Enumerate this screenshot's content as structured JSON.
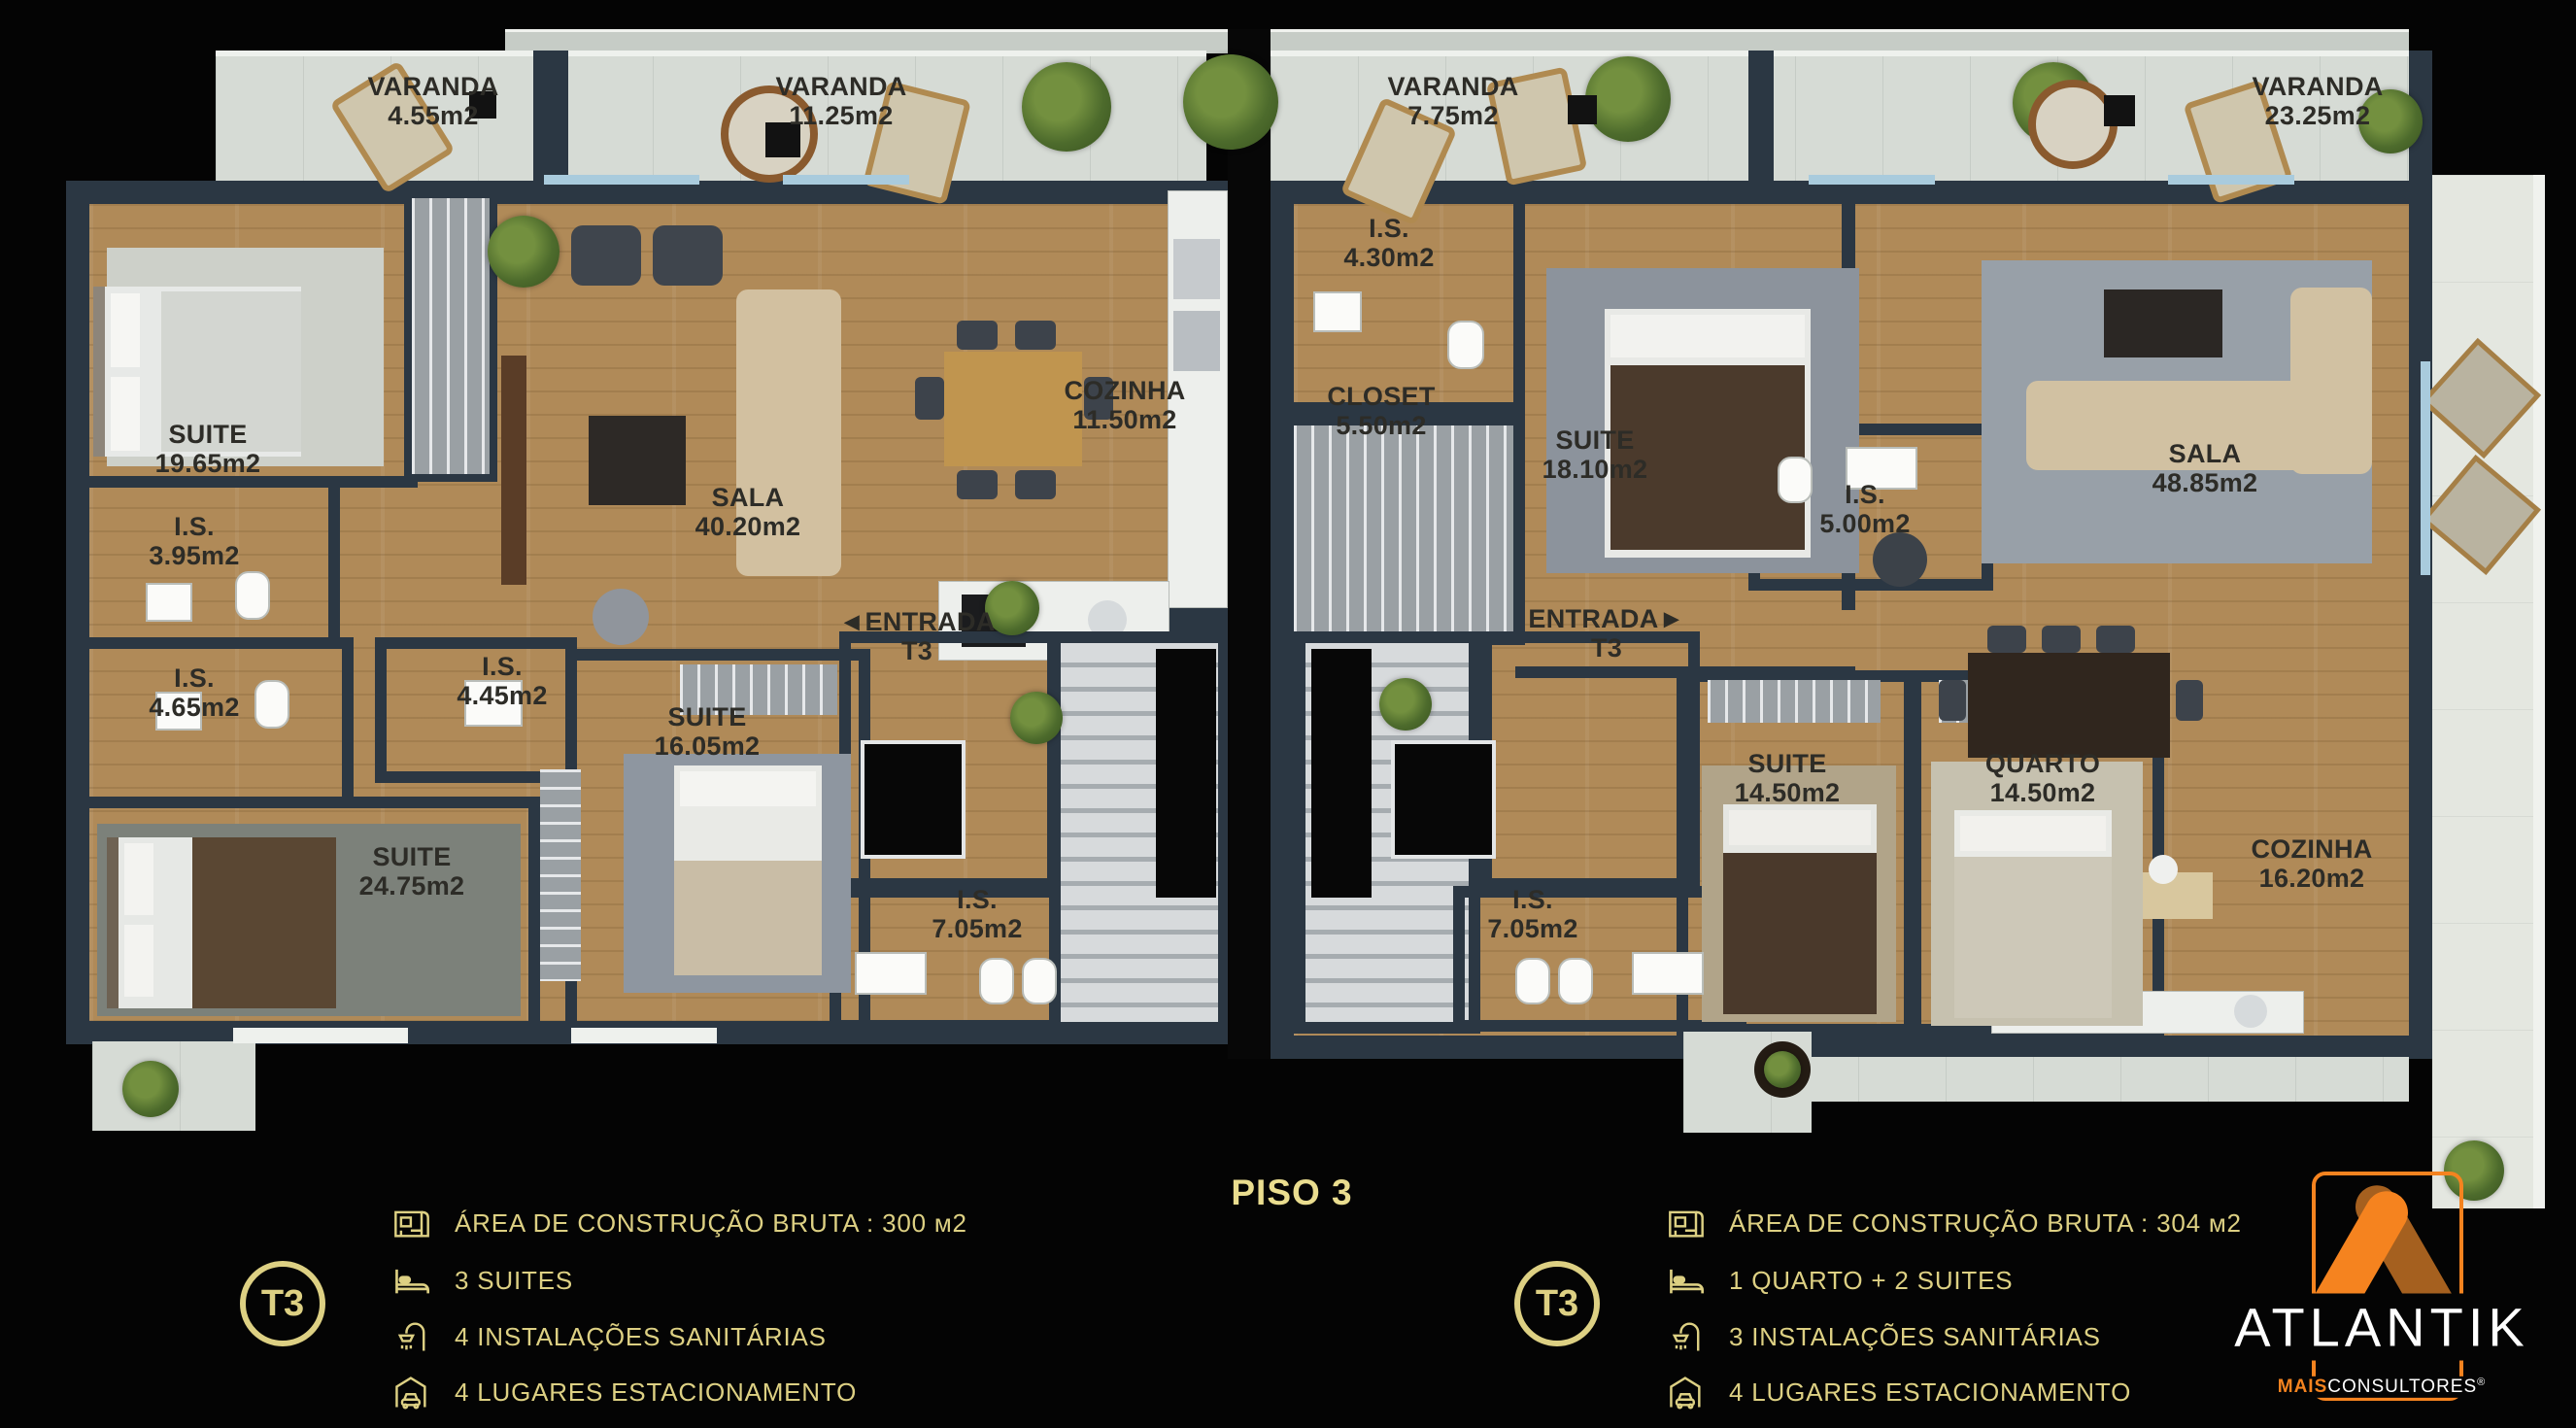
{
  "floor_title": "PISO 3",
  "varandas": [
    {
      "name": "VARANDA",
      "area": "4.55m2"
    },
    {
      "name": "VARANDA",
      "area": "11.25m2"
    },
    {
      "name": "VARANDA",
      "area": "7.75m2"
    },
    {
      "name": "VARANDA",
      "area": "23.25m2"
    }
  ],
  "unit_left": {
    "rooms": [
      {
        "name": "SUITE",
        "area": "19.65m2"
      },
      {
        "name": "I.S.",
        "area": "3.95m2"
      },
      {
        "name": "I.S.",
        "area": "4.65m2"
      },
      {
        "name": "SUITE",
        "area": "24.75m2"
      },
      {
        "name": "I.S.",
        "area": "4.45m2"
      },
      {
        "name": "SUITE",
        "area": "16.05m2"
      },
      {
        "name": "SALA",
        "area": "40.20m2"
      },
      {
        "name": "COZINHA",
        "area": "11.50m2"
      },
      {
        "name": "I.S.",
        "area": "7.05m2"
      }
    ],
    "entrance": {
      "arrow": "◄",
      "name": "ENTRADA",
      "unit": "T3"
    }
  },
  "unit_right": {
    "rooms": [
      {
        "name": "I.S.",
        "area": "4.30m2"
      },
      {
        "name": "CLOSET",
        "area": "5.50m2"
      },
      {
        "name": "SUITE",
        "area": "18.10m2"
      },
      {
        "name": "I.S.",
        "area": "5.00m2"
      },
      {
        "name": "SALA",
        "area": "48.85m2"
      },
      {
        "name": "SUITE",
        "area": "14.50m2"
      },
      {
        "name": "QUARTO",
        "area": "14.50m2"
      },
      {
        "name": "COZINHA",
        "area": "16.20m2"
      },
      {
        "name": "I.S.",
        "area": "7.05m2"
      }
    ],
    "entrance": {
      "arrow": "►",
      "name": "ENTRADA",
      "unit": "T3"
    }
  },
  "legend_left": {
    "badge": "T3",
    "items": [
      {
        "icon": "blueprint-icon",
        "label": "ÁREA DE CONSTRUÇÃO BRUTA :  300 м2"
      },
      {
        "icon": "bed-icon",
        "label": "3 SUITES"
      },
      {
        "icon": "shower-icon",
        "label": "4 INSTALAÇÕES SANITÁRIAS"
      },
      {
        "icon": "car-icon",
        "label": "4 LUGARES ESTACIONAMENTO"
      }
    ]
  },
  "legend_right": {
    "badge": "T3",
    "items": [
      {
        "icon": "blueprint-icon",
        "label": "ÁREA DE CONSTRUÇÃO BRUTA :  304 м2"
      },
      {
        "icon": "bed-icon",
        "label": "1 QUARTO + 2 SUITES"
      },
      {
        "icon": "shower-icon",
        "label": "3 INSTALAÇÕES SANITÁRIAS"
      },
      {
        "icon": "car-icon",
        "label": "4 LUGARES ESTACIONAMENTO"
      }
    ]
  },
  "logo": {
    "brand": "ATLANTIK",
    "sub_bold": "MAIS",
    "sub_rest": "CONSULTORES",
    "reg": "®"
  },
  "colors": {
    "legend_gold": "#ddd083",
    "piso_gold": "#eadd8f",
    "logo_orange": "#f5831f",
    "logo_orange_dark": "#a5601f"
  }
}
